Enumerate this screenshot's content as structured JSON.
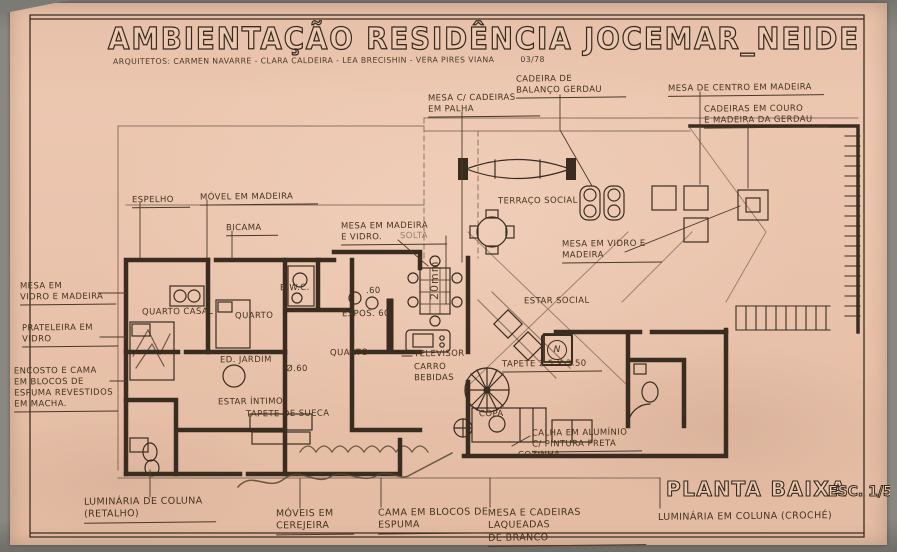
{
  "colors": {
    "paper": "#e8c1aa",
    "ink": "#3a2d20",
    "scan_border": "#84827d",
    "pencil": "#8a7360"
  },
  "title": {
    "main": "AMBIENTAÇÃO RESIDÊNCIA JOCEMAR_NEIDE",
    "subtitle": "ARQUITETOS: CARMEN NAVARRE - CLARA CALDEIRA - LEA BRECISHIN - VERA PIRES VIANA",
    "date": "03/78"
  },
  "plan_title": {
    "label": "PLANTA BAIXA",
    "scale": "ESC. 1/50"
  },
  "annotations": [
    {
      "text": "MESA C/ CADEIRAS\nEM PALHA"
    },
    {
      "text": "CADEIRA DE\nBALANÇO GERDAU"
    },
    {
      "text": "MESA DE CENTRO EM MADEIRA"
    },
    {
      "text": "CADEIRAS EM COURO\nE MADEIRA DA GERDAU"
    },
    {
      "text": "ESPELHO"
    },
    {
      "text": "MÓVEL EM MADEIRA"
    },
    {
      "text": "BICAMA"
    },
    {
      "text": "MESA EM MADEIRA\nE VIDRO."
    },
    {
      "text": "SOLTA"
    },
    {
      "text": "MESA EM\nVIDRO E MADEIRA"
    },
    {
      "text": "PRATELEIRA EM\nVIDRO"
    },
    {
      "text": "ENCOSTO E CAMA\nEM BLOCOS DE\nESPUMA REVESTIDOS\nEM MACHA."
    },
    {
      "text": "TERRAÇO SOCIAL"
    },
    {
      "text": "MESA EM VIDRO E\nMADEIRA"
    },
    {
      "text": "ESTAR SOCIAL"
    },
    {
      "text": "TAPETE 2.5 X 3.50"
    },
    {
      "text": "QUARTO CASAL"
    },
    {
      "text": "QUARTO"
    },
    {
      "text": "B.W.C."
    },
    {
      "text": "ESPOS. 60"
    },
    {
      "text": "QUARTO"
    },
    {
      "text": "ED. JARDIM"
    },
    {
      "text": "Ø.60"
    },
    {
      "text": "ESTAR ÍNTIMO"
    },
    {
      "text": "TAPETE DE SUECA"
    },
    {
      "text": "TELEVISOR"
    },
    {
      "text": "CARRO\nBEBIDAS"
    },
    {
      "text": "COPA"
    },
    {
      "text": "CALHA EM ALUMÍNIO\nC/ PINTURA PRETA"
    },
    {
      "text": "COZINHA"
    },
    {
      "text": "LUMINÁRIA DE COLUNA\n(RETALHO)"
    },
    {
      "text": "MÓVEIS EM\nCEREJEIRA"
    },
    {
      "text": "CAMA EM BLOCOS DE\nESPUMA"
    },
    {
      "text": "MESA E CADEIRAS LAQUEADAS\nDE BRANCO"
    },
    {
      "text": "LUMINÁRIA EM COLUNA (CROCHÉ)"
    },
    {
      "text": "20mm"
    },
    {
      "text": ".60"
    },
    {
      "text": "N"
    }
  ]
}
